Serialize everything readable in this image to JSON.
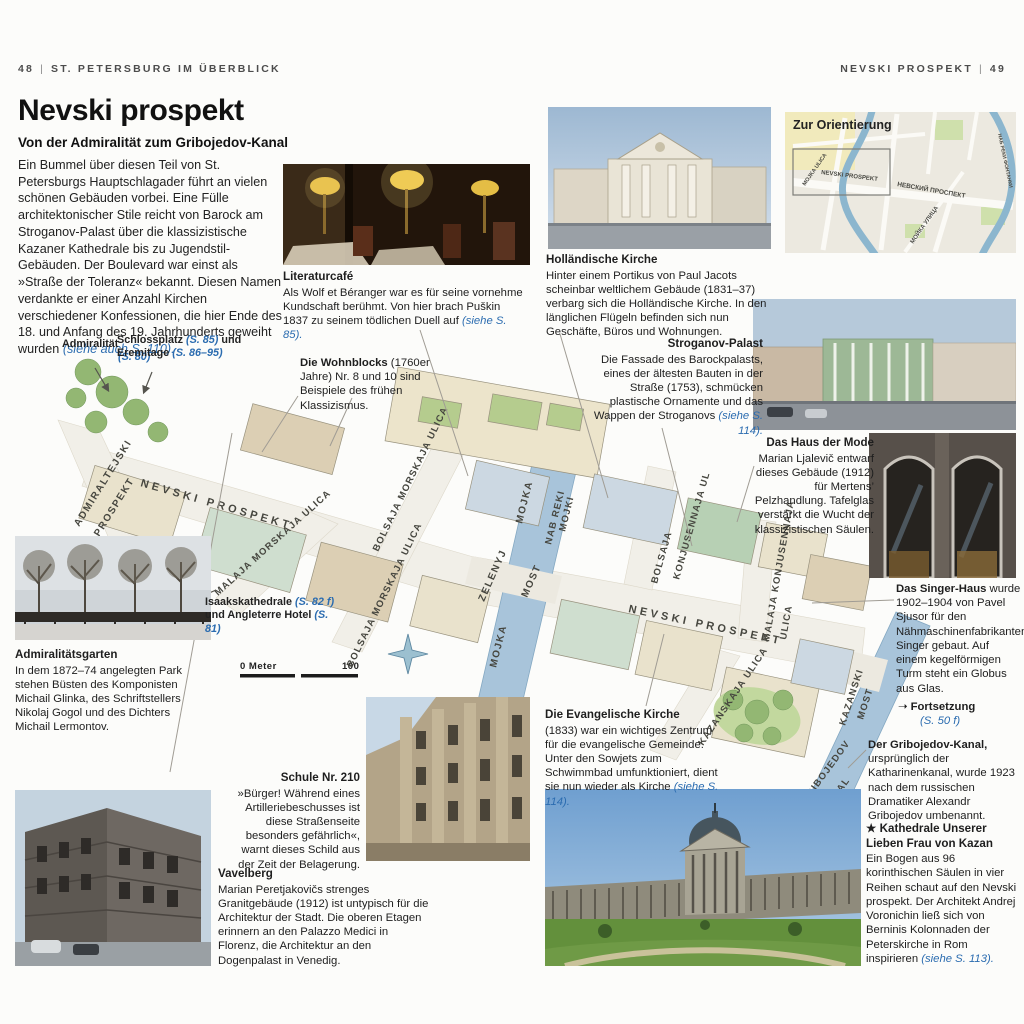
{
  "page": {
    "header_left_num": "48",
    "header_left_title": "ST. PETERSBURG IM ÜBERBLICK",
    "header_right_title": "NEVSKI PROSPEKT",
    "header_right_num": "49",
    "title": "Nevski prospekt",
    "subtitle": "Von der Admiralität zum Gribojedov-Kanal",
    "intro_text": "Ein Bummel über diesen Teil von St. Petersburgs Hauptschlagader führt an vielen schönen Gebäuden vorbei. Eine Fülle architektonischer Stile reicht von Barock am Stroganov-Palast über die klassizistische Kazaner Kathedrale bis zu Jugendstil-Gebäuden. Der Boulevard war einst als »Straße der Toleranz« bekannt. Diesen Namen verdankte er einer Anzahl Kirchen verschiedener Konfessionen, die hier Ende des 18. und Anfang des 19. Jahrhunderts geweiht wurden ",
    "intro_ref": "(siehe auch S. 110)."
  },
  "callouts": {
    "literaturcafe": {
      "heading": "Literaturcafé",
      "body": "Als Wolf et Béranger war es für seine vornehme Kundschaft berühmt. Von hier brach Puškin 1837 zu seinem tödlichen Duell auf ",
      "ref": "(siehe S. 85)."
    },
    "wohnblocks": {
      "heading": "Die Wohnblocks",
      "suffix": " (1760er Jahre) Nr. 8 und 10 sind Beispiele des frühen Klassizismus."
    },
    "hollaendische_kirche": {
      "heading": "Holländische Kirche",
      "body": "Hinter einem Portikus von Paul Jacots scheinbar weltlichem Gebäude (1831–37) verbarg sich die Holländische Kirche. In den länglichen Flügeln befinden sich nun Geschäfte, Büros und Wohnungen."
    },
    "stroganov": {
      "heading": "Stroganov-Palast",
      "body": "Die Fassade des Barockpalasts, eines der ältesten Bauten in der Straße (1753), schmücken plastische Ornamente und das Wappen der Stroganovs ",
      "ref": "(siehe S. 114)."
    },
    "haus_der_mode": {
      "heading": "Das Haus der Mode",
      "body": "Marian Ljalevič entwarf dieses Gebäude (1912) für Mertens’ Pelzhandlung. Tafelglas verstärkt die Wucht der klassizistischen Säulen."
    },
    "singer_haus": {
      "heading": "Das Singer-Haus",
      "body": " wurde 1902–1904 von Pavel Sjusor für den Nähmaschinenfabrikanten Singer gebaut. Auf einem kegelförmigen Turm steht ein Globus aus Glas."
    },
    "fortsetzung": {
      "arrow": "➝",
      "label": "Fortsetzung",
      "ref": "(S. 50 f)"
    },
    "gribojedov": {
      "heading": "Der Gribojedov-Kanal,",
      "body": " ursprünglich der Katharinenkanal, wurde 1923 nach dem russischen Dramatiker Alexandr Gribojedov umbenannt."
    },
    "kazan": {
      "star": "★",
      "heading": "Kathedrale Unserer Lieben Frau von Kazan",
      "body": "Ein Bogen aus 96 korinthischen Säulen in vier Reihen schaut auf den Nevski prospekt. Der Architekt Andrej Voronichin ließ sich von Berninis Kolonnaden der Peterskirche in Rom inspirieren ",
      "ref": "(siehe S. 113)."
    },
    "evangelische": {
      "heading": "Die Evangelische Kirche",
      "body": "(1833) war ein wichtiges Zentrum für die evangelische Gemeinde. Unter den Sowjets zum Schwimmbad umfunktioniert, dient sie nun wieder als Kirche ",
      "ref": "(siehe S. 114)."
    },
    "schule": {
      "heading": "Schule Nr. 210",
      "body": "»Bürger! Während eines Artilleriebeschusses ist diese Straßenseite besonders gefährlich«, warnt dieses Schild aus der Zeit der Belagerung."
    },
    "vavelberg": {
      "heading": "Vavelberg",
      "body": "Marian Peretjakovičs strenges Granitgebäude (1912) ist untypisch für die Architektur der Stadt. Die oberen Etagen erinnern an den Palazzo Medici in Florenz, die Architektur an den Dogenpalast in Venedig."
    },
    "admiralitaetsgarten": {
      "heading": "Admiralitätsgarten",
      "body": "In dem 1872–74 angelegten Park stehen Büsten des Komponisten Michail Glinka, des Schriftstellers Nikolaj Gogol und des Dichters Michail Lermontov."
    }
  },
  "maplabels": {
    "admiralitaet": {
      "name": "Admiralität",
      "ref": "(S. 80)"
    },
    "schlossplatz": {
      "t1": "Schlossplatz ",
      "r1": "(S. 85)",
      "t2": " und",
      "t3": "Eremitage ",
      "r2": "(S. 86–95)"
    },
    "isaak": {
      "t1": "Isaakskathedrale ",
      "r1": "(S. 82 f)",
      "t2": " und Angleterre Hotel ",
      "r2": "(S. 81)"
    }
  },
  "map": {
    "street_labels": [
      "ADMIRALTEJSKI",
      "PROSPEKT",
      "NEVSKI PROSPEKT",
      "MALAJA MORSKAJA ULICA",
      "BOLSAJA MORSKAJA ULICA",
      "BOLSAJA MORSKAJA ULICA",
      "ZELENYJ",
      "MOST",
      "MOJKA",
      "NAB REKI",
      "MOJKI",
      "MOJKA",
      "NEVSKI PROSPEKT",
      "BOLSAJA",
      "KONJUSENNAJA UL",
      "MALAJA KONJUSENNAJA",
      "ULICA",
      "KAZANSKAJA ULICA",
      "KAZANSKI",
      "MOST",
      "GRIBOJEDOV",
      "KANAL"
    ],
    "scale": {
      "left": "0 Meter",
      "right": "100"
    },
    "orientierung": {
      "title": "Zur Orientierung",
      "labels": [
        "NEVSKI PROSPEKT",
        "НЕВСКИЙ ПРОСПЕКТ",
        "MOJKA ULICA",
        "МОЙКА УЛИЦА",
        "НАБ РЕКИ ФОНТАНКИ"
      ]
    }
  },
  "colors": {
    "ref_blue": "#2b6cb0",
    "river": "#a8c4da",
    "street": "#f1efe8"
  }
}
